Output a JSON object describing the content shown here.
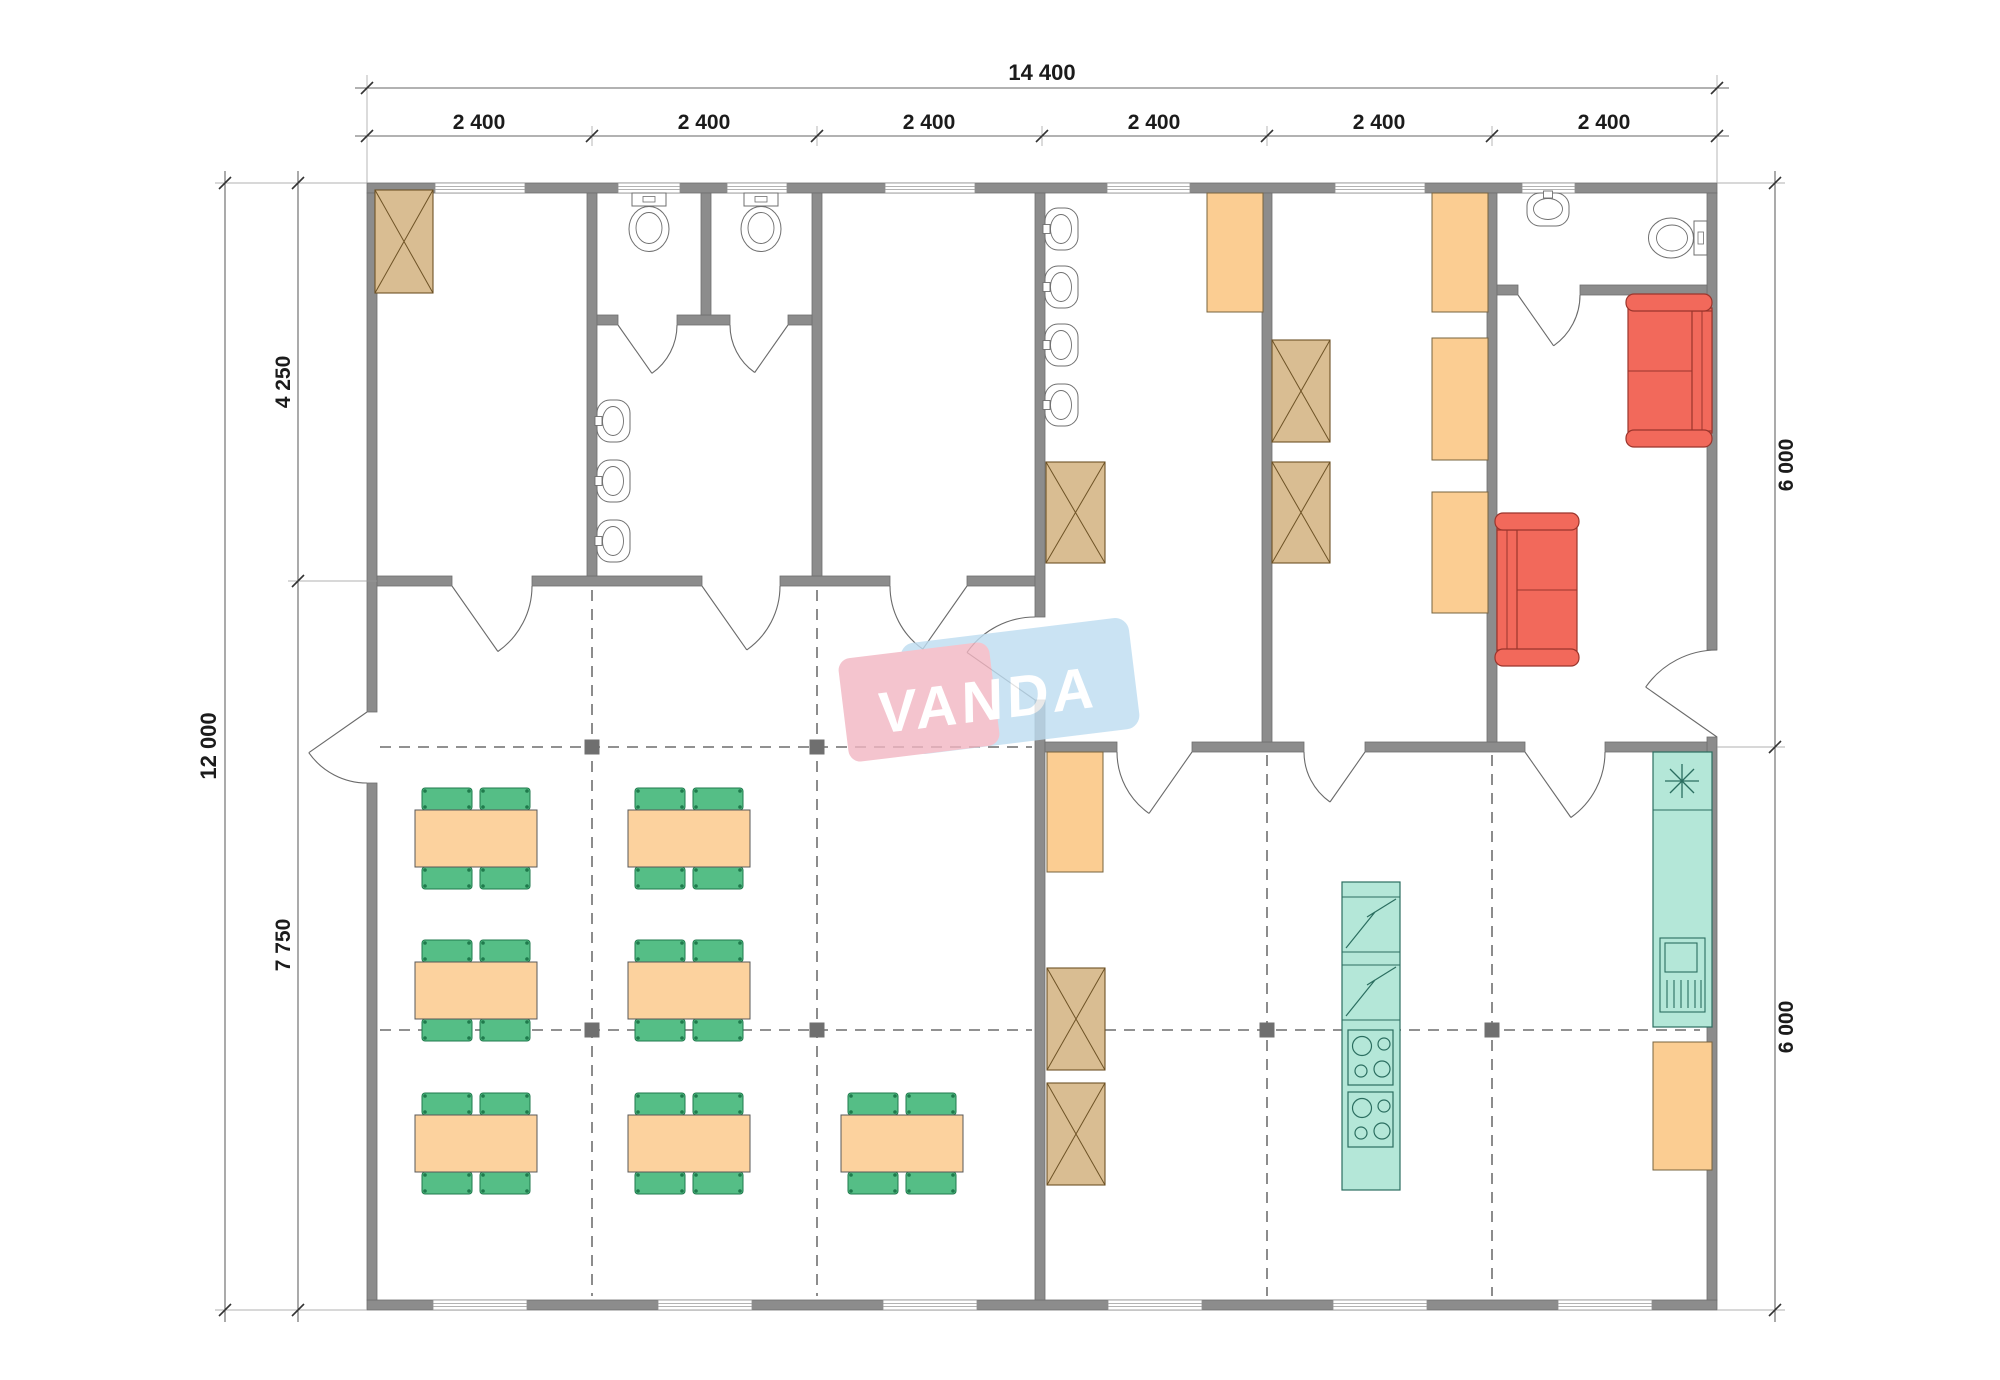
{
  "document": {
    "type": "architectural-floor-plan",
    "units": "mm"
  },
  "watermark": {
    "text": "VANDA",
    "pink": "#F2B6C2",
    "blue": "#BEDDF1",
    "text_color": "#FFFFFF"
  },
  "dimensions": {
    "top_total": "14 400",
    "top_bays": [
      "2 400",
      "2 400",
      "2 400",
      "2 400",
      "2 400",
      "2 400"
    ],
    "left_total": "12 000",
    "left_upper": "4 250",
    "left_lower": "7 750",
    "right_upper": "6 000",
    "right_lower": "6 000"
  },
  "colors": {
    "wall": "#8C8C8C",
    "wall_edge": "#6F6F6F",
    "fixture_line": "#6F6F6F",
    "wood": "#D9BD92",
    "wood_line": "#6E5326",
    "locker_orange": "#FBCD92",
    "locker_line": "#77643F",
    "table_orange": "#FCD29E",
    "table_line": "#585858",
    "chair_green": "#55BE86",
    "chair_line": "#1F7A4C",
    "kitchen_teal": "#B4E7D8",
    "kitchen_line": "#2B6E60",
    "sofa_red": "#F2695B",
    "sofa_line": "#9A352C",
    "grid_line": "#4F4F4F",
    "grid_marker": "#6F6F6F",
    "dim_line": "#666666",
    "dim_text": "#1B1B1B"
  },
  "furniture_inventory": {
    "dining_sets_4_chairs": 7,
    "sofas_two_seat": 2,
    "toilets": 3,
    "wall_sinks": 8,
    "crossed_wardrobes": 6,
    "orange_lockers": 6,
    "fridges_with_lightning": 2,
    "stoves_4_burner": 2,
    "dishwasher": 1,
    "kitchen_sink_star": 1
  },
  "icons": {
    "wardrobe": "crossed-box-icon",
    "locker": "orange-box-icon",
    "toilet": "toilet-top-view-icon",
    "sink": "basin-top-view-icon",
    "kitchen_sink": "asterisk-icon",
    "fridge": "lightning-box-icon",
    "stove": "four-burner-icon",
    "dishwasher": "grate-box-icon",
    "sofa": "sofa-top-view-icon",
    "dining_set": "table-four-chairs-icon",
    "door": "quarter-arc-icon",
    "window": "double-line-window-icon",
    "grid_marker": "filled-square-icon"
  },
  "plan": {
    "walls": [
      [
        367,
        183,
        1350,
        10
      ],
      [
        367,
        1300,
        1350,
        10
      ],
      [
        367,
        193,
        10,
        519
      ],
      [
        367,
        783,
        10,
        517
      ],
      [
        1707,
        193,
        10,
        457
      ],
      [
        1707,
        737,
        10,
        563
      ],
      [
        377,
        576,
        75,
        10
      ],
      [
        532,
        576,
        170,
        10
      ],
      [
        780,
        576,
        110,
        10
      ],
      [
        967,
        576,
        68,
        10
      ],
      [
        1035,
        193,
        10,
        424
      ],
      [
        1035,
        700,
        10,
        600
      ],
      [
        1045,
        742,
        72,
        10
      ],
      [
        1192,
        742,
        112,
        10
      ],
      [
        1365,
        742,
        160,
        10
      ],
      [
        1605,
        742,
        102,
        10
      ],
      [
        587,
        193,
        10,
        383
      ],
      [
        812,
        193,
        10,
        383
      ],
      [
        1262,
        193,
        10,
        549
      ],
      [
        1487,
        193,
        10,
        549
      ],
      [
        597,
        315,
        21,
        10
      ],
      [
        677,
        315,
        53,
        10
      ],
      [
        788,
        315,
        24,
        10
      ],
      [
        701,
        193,
        10,
        122
      ],
      [
        1497,
        285,
        21,
        10
      ],
      [
        1580,
        285,
        127,
        10
      ]
    ],
    "windows_top": [
      [
        435,
        90
      ],
      [
        618,
        62
      ],
      [
        727,
        60
      ],
      [
        885,
        90
      ],
      [
        1107,
        83
      ],
      [
        1335,
        90
      ],
      [
        1522,
        53
      ]
    ],
    "windows_bottom": [
      [
        433,
        94
      ],
      [
        658,
        94
      ],
      [
        883,
        94
      ],
      [
        1108,
        94
      ],
      [
        1333,
        94
      ],
      [
        1558,
        94
      ]
    ],
    "grid_v": [
      [
        592,
        590,
        1296
      ],
      [
        817,
        590,
        1296
      ],
      [
        1267,
        755,
        1296
      ],
      [
        1492,
        755,
        1296
      ]
    ],
    "grid_h": [
      [
        747,
        380,
        1032
      ],
      [
        1030,
        380,
        1032
      ],
      [
        1030,
        1048,
        1700
      ]
    ],
    "grid_markers": [
      [
        592,
        747
      ],
      [
        817,
        747
      ],
      [
        592,
        1030
      ],
      [
        817,
        1030
      ],
      [
        1267,
        1030
      ],
      [
        1492,
        1030
      ]
    ],
    "wardrobes": [
      [
        375,
        190,
        58,
        103
      ],
      [
        1046,
        462,
        59,
        101
      ],
      [
        1272,
        340,
        58,
        102
      ],
      [
        1272,
        462,
        58,
        101
      ],
      [
        1047,
        968,
        58,
        102
      ],
      [
        1047,
        1083,
        58,
        102
      ]
    ],
    "lockers": [
      [
        1207,
        193,
        56,
        119
      ],
      [
        1432,
        193,
        56,
        119
      ],
      [
        1432,
        338,
        56,
        122
      ],
      [
        1432,
        492,
        56,
        121
      ],
      [
        1047,
        752,
        56,
        120
      ],
      [
        1653,
        1042,
        59,
        128
      ]
    ],
    "dining_sets": [
      [
        415,
        810
      ],
      [
        628,
        810
      ],
      [
        415,
        962
      ],
      [
        628,
        962
      ],
      [
        415,
        1115
      ],
      [
        628,
        1115
      ],
      [
        841,
        1115
      ]
    ],
    "sinks": [
      {
        "x": 597,
        "y": 421,
        "r": 0
      },
      {
        "x": 597,
        "y": 481,
        "r": 0
      },
      {
        "x": 597,
        "y": 541,
        "r": 0
      },
      {
        "x": 1045,
        "y": 229,
        "r": 0
      },
      {
        "x": 1045,
        "y": 287,
        "r": 0
      },
      {
        "x": 1045,
        "y": 345,
        "r": 0
      },
      {
        "x": 1045,
        "y": 405,
        "r": 0
      },
      {
        "x": 1548,
        "y": 193,
        "r": 90
      }
    ],
    "toilets": [
      {
        "x": 649,
        "y": 193,
        "r": 0
      },
      {
        "x": 761,
        "y": 193,
        "r": 0
      },
      {
        "x": 1707,
        "y": 238,
        "r": 90
      }
    ]
  }
}
